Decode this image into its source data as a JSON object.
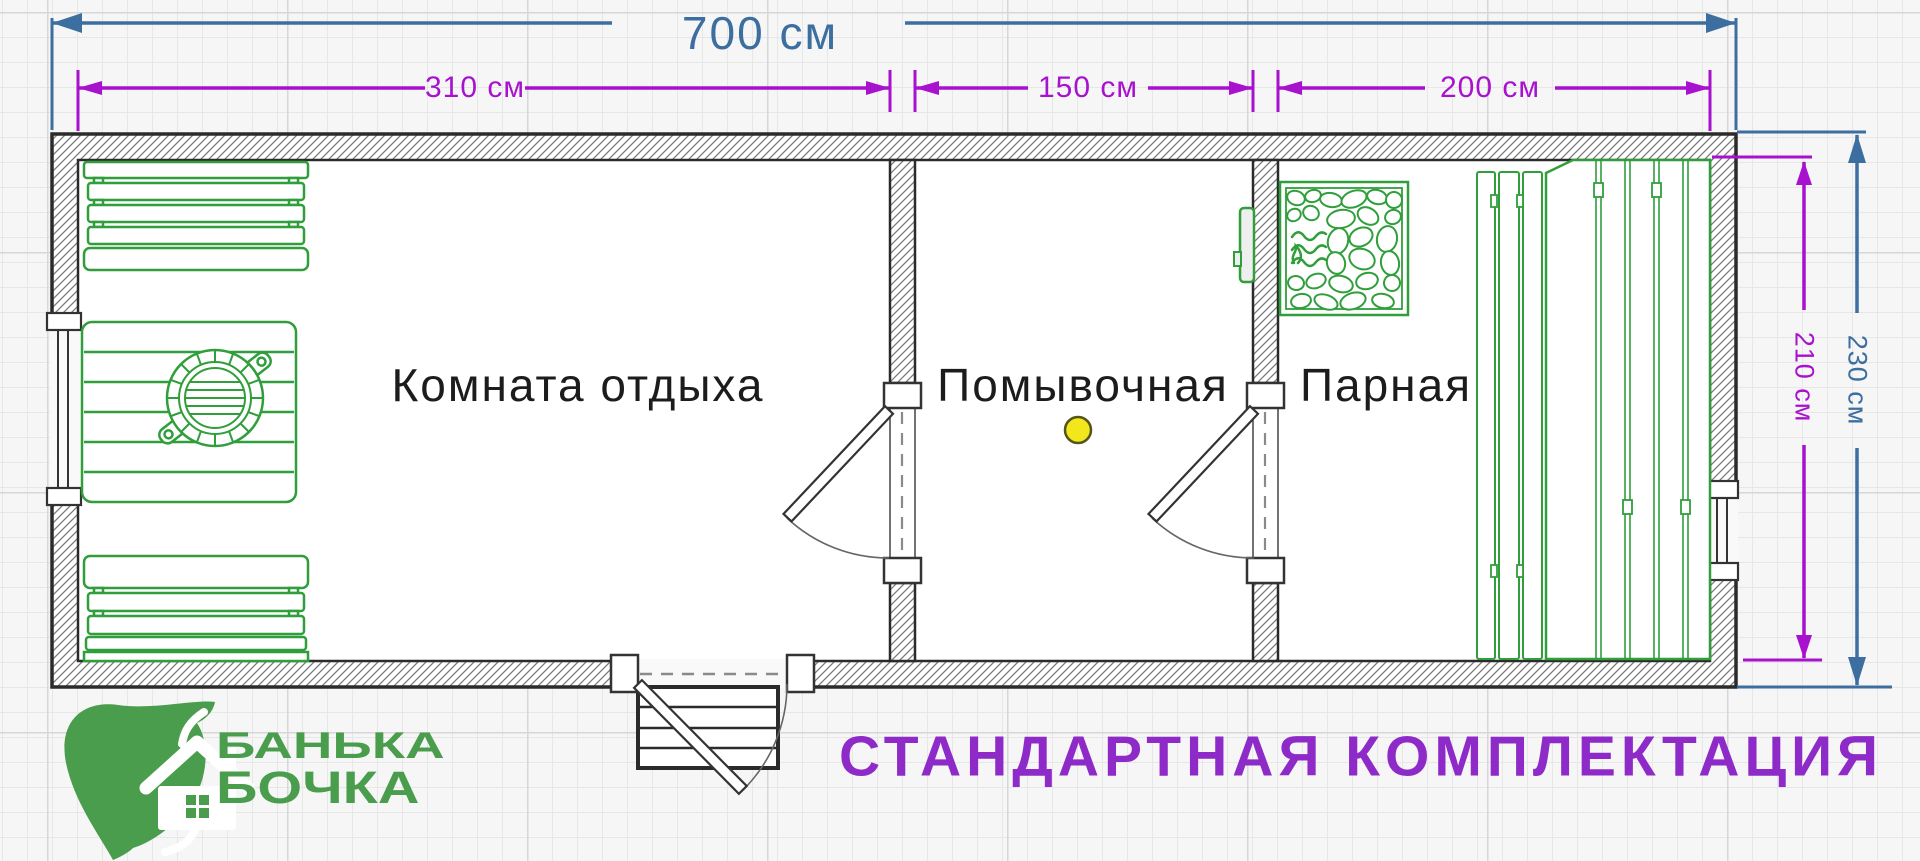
{
  "palette": {
    "dimension_blue": "#3c6e9f",
    "dimension_magenta": "#a811ce",
    "caption_purple": "#8e2ac8",
    "plan_green": "#2f9e3b",
    "logo_green": "#4a9d4c",
    "drain_yellow": "#f2e71d",
    "wall_dark": "#2b2b2b"
  },
  "dimensions": {
    "overall_width": {
      "label": "700 см"
    },
    "room_widths": [
      {
        "label": "310 см"
      },
      {
        "label": "150 см"
      },
      {
        "label": "200 см"
      }
    ],
    "inner_height": {
      "label": "210 см"
    },
    "overall_height": {
      "label": "230 см"
    }
  },
  "rooms": [
    {
      "name": "Комната отдыха"
    },
    {
      "name": "Помывочная"
    },
    {
      "name": "Парная"
    }
  ],
  "icons": [
    "bench-icon",
    "table-icon",
    "barrel-icon",
    "drain-icon",
    "stove-icon",
    "fire-icon",
    "steps-icon",
    "door-icon",
    "window-icon",
    "leaf-house-logo-icon"
  ],
  "logo": {
    "line1": "БАНЬКА",
    "line2": "БОЧКА"
  },
  "caption": {
    "text": "СТАНДАРТНАЯ КОМПЛЕКТАЦИЯ"
  }
}
